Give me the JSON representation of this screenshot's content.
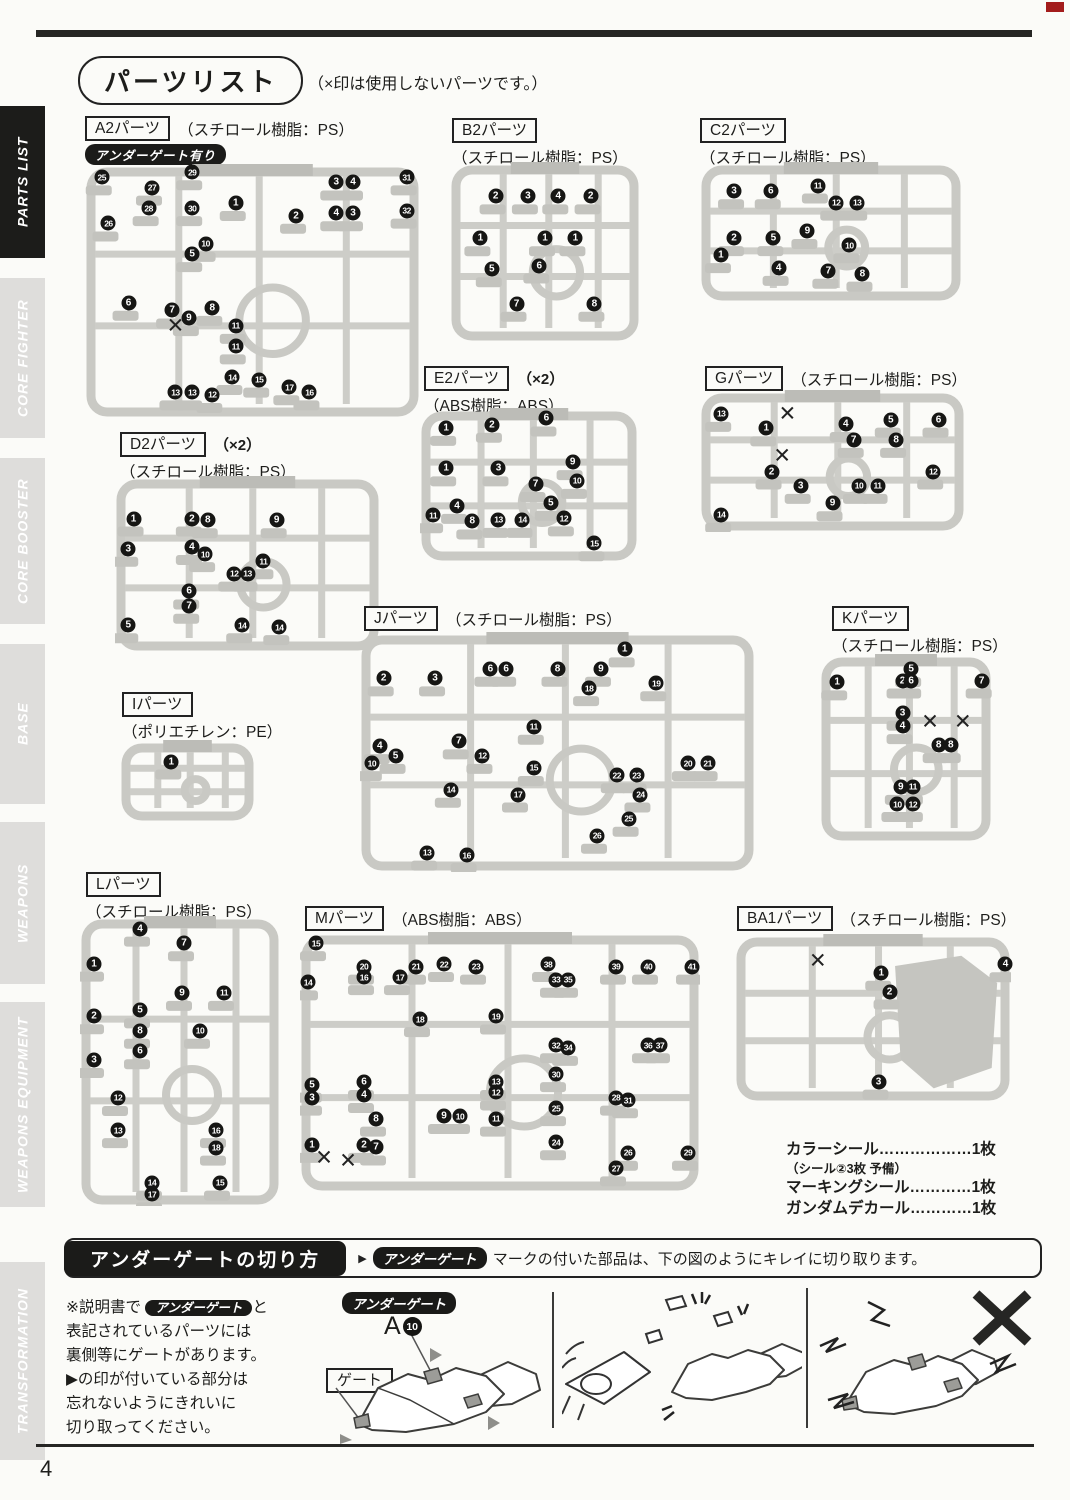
{
  "page": {
    "number": "4"
  },
  "header": {
    "title": "パーツリスト",
    "note": "（×印は使用しないパーツです。）"
  },
  "sidebar": [
    {
      "label": "PARTS LIST",
      "active": true,
      "top": 106,
      "height": 152
    },
    {
      "label": "CORE FIGHTER",
      "top": 278,
      "height": 160
    },
    {
      "label": "CORE BOOSTER",
      "top": 458,
      "height": 166
    },
    {
      "label": "BASE",
      "top": 644,
      "height": 160
    },
    {
      "label": "WEAPONS",
      "top": 822,
      "height": 162
    },
    {
      "label": "WEAPONS EQUIPMENT",
      "top": 1002,
      "height": 205
    },
    {
      "label": "TRANSFORMATION",
      "top": 1262,
      "height": 198
    }
  ],
  "runners": [
    {
      "id": "a2",
      "label": "A2パーツ",
      "mult": "",
      "material": "（スチロール樹脂：PS）",
      "inline": true,
      "badge": "アンダーゲート有り",
      "head": [
        85,
        116
      ],
      "diag": [
        85,
        162,
        335,
        256
      ],
      "nums": [
        [
          25,
          5,
          6
        ],
        [
          27,
          20,
          10
        ],
        [
          29,
          32,
          4
        ],
        [
          28,
          19,
          18
        ],
        [
          26,
          7,
          24
        ],
        [
          30,
          32,
          18
        ],
        [
          1,
          45,
          16
        ],
        [
          2,
          63,
          21
        ],
        [
          3,
          75,
          8
        ],
        [
          4,
          80,
          8
        ],
        [
          4,
          75,
          20
        ],
        [
          3,
          80,
          20
        ],
        [
          31,
          96,
          6
        ],
        [
          32,
          96,
          19
        ],
        [
          5,
          32,
          36
        ],
        [
          10,
          36,
          32
        ],
        [
          6,
          13,
          55
        ],
        [
          7,
          26,
          58
        ],
        [
          9,
          31,
          61
        ],
        [
          8,
          38,
          57
        ],
        [
          11,
          45,
          64
        ],
        [
          11,
          45,
          72
        ],
        [
          13,
          27,
          90
        ],
        [
          13,
          32,
          90
        ],
        [
          12,
          38,
          91
        ],
        [
          14,
          44,
          84
        ],
        [
          15,
          52,
          85
        ],
        [
          17,
          61,
          88
        ],
        [
          16,
          67,
          90
        ]
      ],
      "xmarks": [
        [
          27,
          64
        ]
      ]
    },
    {
      "id": "b2",
      "label": "B2パーツ",
      "mult": "",
      "material": "（スチロール樹脂：PS）",
      "inline": false,
      "badge": "",
      "head": [
        452,
        118
      ],
      "diag": [
        450,
        160,
        190,
        182
      ],
      "nums": [
        [
          2,
          24,
          20
        ],
        [
          3,
          41,
          20
        ],
        [
          4,
          57,
          20
        ],
        [
          2,
          74,
          20
        ],
        [
          1,
          16,
          43
        ],
        [
          1,
          50,
          43
        ],
        [
          1,
          66,
          43
        ],
        [
          5,
          22,
          60
        ],
        [
          6,
          47,
          58
        ],
        [
          7,
          35,
          79
        ],
        [
          8,
          76,
          79
        ]
      ],
      "xmarks": []
    },
    {
      "id": "c2",
      "label": "C2パーツ",
      "mult": "",
      "material": "（スチロール樹脂：PS）",
      "inline": false,
      "badge": "",
      "head": [
        700,
        118
      ],
      "diag": [
        700,
        160,
        262,
        142
      ],
      "nums": [
        [
          3,
          13,
          22
        ],
        [
          6,
          27,
          22
        ],
        [
          11,
          45,
          18
        ],
        [
          12,
          52,
          30
        ],
        [
          13,
          60,
          30
        ],
        [
          2,
          13,
          55
        ],
        [
          5,
          28,
          55
        ],
        [
          9,
          41,
          50
        ],
        [
          10,
          57,
          60
        ],
        [
          1,
          8,
          67
        ],
        [
          4,
          30,
          76
        ],
        [
          7,
          49,
          78
        ],
        [
          8,
          62,
          80
        ]
      ],
      "xmarks": []
    },
    {
      "id": "e2",
      "label": "E2パーツ",
      "mult": "（×2）",
      "material": "（ABS樹脂：ABS）",
      "inline": false,
      "badge": "",
      "head": [
        424,
        366
      ],
      "diag": [
        420,
        406,
        218,
        156
      ],
      "nums": [
        [
          1,
          12,
          14
        ],
        [
          2,
          33,
          12
        ],
        [
          6,
          58,
          8
        ],
        [
          1,
          12,
          40
        ],
        [
          3,
          36,
          40
        ],
        [
          9,
          70,
          36
        ],
        [
          7,
          53,
          50
        ],
        [
          10,
          72,
          48
        ],
        [
          11,
          6,
          70
        ],
        [
          4,
          17,
          64
        ],
        [
          8,
          24,
          74
        ],
        [
          13,
          36,
          73
        ],
        [
          14,
          47,
          73
        ],
        [
          5,
          60,
          62
        ],
        [
          12,
          66,
          72
        ],
        [
          15,
          80,
          88
        ]
      ],
      "xmarks": []
    },
    {
      "id": "g",
      "label": "Gパーツ",
      "mult": "",
      "material": "（スチロール樹脂：PS）",
      "inline": true,
      "badge": "",
      "head": [
        705,
        366
      ],
      "diag": [
        700,
        388,
        265,
        144
      ],
      "nums": [
        [
          13,
          8,
          18
        ],
        [
          1,
          25,
          28
        ],
        [
          4,
          55,
          25
        ],
        [
          5,
          72,
          22
        ],
        [
          6,
          90,
          22
        ],
        [
          7,
          58,
          36
        ],
        [
          8,
          74,
          36
        ],
        [
          2,
          27,
          58
        ],
        [
          3,
          38,
          68
        ],
        [
          10,
          60,
          68
        ],
        [
          11,
          67,
          68
        ],
        [
          12,
          88,
          58
        ],
        [
          9,
          50,
          80
        ],
        [
          14,
          8,
          88
        ]
      ],
      "xmarks": [
        [
          33,
          18
        ],
        [
          31,
          47
        ]
      ]
    },
    {
      "id": "d2",
      "label": "D2パーツ",
      "mult": "（×2）",
      "material": "（スチロール樹脂：PS）",
      "inline": false,
      "badge": "",
      "head": [
        120,
        432
      ],
      "diag": [
        115,
        474,
        265,
        178
      ],
      "nums": [
        [
          1,
          7,
          25
        ],
        [
          2,
          29,
          25
        ],
        [
          8,
          35,
          26
        ],
        [
          9,
          61,
          26
        ],
        [
          3,
          5,
          42
        ],
        [
          4,
          29,
          41
        ],
        [
          10,
          34,
          45
        ],
        [
          11,
          56,
          49
        ],
        [
          12,
          45,
          56
        ],
        [
          13,
          50,
          56
        ],
        [
          6,
          28,
          66
        ],
        [
          7,
          28,
          74
        ],
        [
          5,
          5,
          85
        ],
        [
          14,
          48,
          85
        ],
        [
          14,
          62,
          86
        ]
      ],
      "xmarks": []
    },
    {
      "id": "i",
      "label": "Iパーツ",
      "mult": "",
      "material": "（ポリエチレン：PE）",
      "inline": false,
      "badge": "",
      "head": [
        122,
        692
      ],
      "diag": [
        120,
        738,
        135,
        84
      ],
      "nums": [
        [
          1,
          38,
          28
        ]
      ],
      "xmarks": []
    },
    {
      "id": "j",
      "label": "Jパーツ",
      "mult": "",
      "material": "（スチロール樹脂：PS）",
      "inline": true,
      "badge": "",
      "head": [
        364,
        606
      ],
      "diag": [
        360,
        630,
        395,
        242
      ],
      "nums": [
        [
          2,
          6,
          20
        ],
        [
          3,
          19,
          20
        ],
        [
          6,
          33,
          16
        ],
        [
          6,
          37,
          16
        ],
        [
          8,
          50,
          16
        ],
        [
          9,
          61,
          16
        ],
        [
          1,
          67,
          8
        ],
        [
          18,
          58,
          24
        ],
        [
          19,
          75,
          22
        ],
        [
          20,
          83,
          55
        ],
        [
          21,
          88,
          55
        ],
        [
          4,
          5,
          48
        ],
        [
          7,
          25,
          46
        ],
        [
          10,
          3,
          55
        ],
        [
          12,
          31,
          52
        ],
        [
          11,
          44,
          40
        ],
        [
          5,
          9,
          52
        ],
        [
          15,
          44,
          57
        ],
        [
          17,
          40,
          68
        ],
        [
          14,
          23,
          66
        ],
        [
          13,
          17,
          92
        ],
        [
          16,
          27,
          93
        ],
        [
          22,
          65,
          60
        ],
        [
          23,
          70,
          60
        ],
        [
          24,
          71,
          68
        ],
        [
          25,
          68,
          78
        ],
        [
          26,
          60,
          85
        ]
      ],
      "xmarks": []
    },
    {
      "id": "k",
      "label": "Kパーツ",
      "mult": "",
      "material": "（スチロール樹脂：PS）",
      "inline": false,
      "badge": "",
      "head": [
        832,
        606
      ],
      "diag": [
        820,
        652,
        172,
        190
      ],
      "nums": [
        [
          1,
          10,
          16
        ],
        [
          5,
          53,
          9
        ],
        [
          2,
          48,
          15
        ],
        [
          6,
          53,
          15
        ],
        [
          7,
          94,
          15
        ],
        [
          3,
          48,
          32
        ],
        [
          4,
          48,
          39
        ],
        [
          8,
          69,
          49
        ],
        [
          8,
          76,
          49
        ],
        [
          9,
          47,
          71
        ],
        [
          11,
          54,
          71
        ],
        [
          10,
          45,
          80
        ],
        [
          12,
          54,
          80
        ]
      ],
      "xmarks": [
        [
          64,
          37
        ],
        [
          83,
          37
        ]
      ]
    },
    {
      "id": "l",
      "label": "Lパーツ",
      "mult": "",
      "material": "（スチロール樹脂：PS）",
      "inline": false,
      "badge": "",
      "head": [
        86,
        872
      ],
      "diag": [
        80,
        914,
        200,
        292
      ],
      "nums": [
        [
          4,
          30,
          5
        ],
        [
          7,
          52,
          10
        ],
        [
          1,
          7,
          17
        ],
        [
          9,
          51,
          27
        ],
        [
          11,
          72,
          27
        ],
        [
          5,
          30,
          33
        ],
        [
          8,
          30,
          40
        ],
        [
          2,
          7,
          35
        ],
        [
          10,
          60,
          40
        ],
        [
          6,
          30,
          47
        ],
        [
          3,
          7,
          50
        ],
        [
          12,
          19,
          63
        ],
        [
          13,
          19,
          74
        ],
        [
          16,
          68,
          74
        ],
        [
          18,
          68,
          80
        ],
        [
          14,
          36,
          92
        ],
        [
          17,
          36,
          96
        ],
        [
          15,
          70,
          92
        ]
      ],
      "xmarks": []
    },
    {
      "id": "m",
      "label": "Mパーツ",
      "mult": "",
      "material": "（ABS樹脂：ABS）",
      "inline": true,
      "badge": "",
      "head": [
        305,
        906
      ],
      "diag": [
        300,
        930,
        400,
        262
      ],
      "nums": [
        [
          15,
          4,
          5
        ],
        [
          20,
          16,
          14
        ],
        [
          21,
          29,
          14
        ],
        [
          22,
          36,
          13
        ],
        [
          23,
          44,
          14
        ],
        [
          38,
          62,
          13
        ],
        [
          39,
          79,
          14
        ],
        [
          40,
          87,
          14
        ],
        [
          41,
          98,
          14
        ],
        [
          14,
          2,
          20
        ],
        [
          16,
          16,
          18
        ],
        [
          17,
          25,
          18
        ],
        [
          33,
          64,
          19
        ],
        [
          35,
          67,
          19
        ],
        [
          18,
          30,
          34
        ],
        [
          19,
          49,
          33
        ],
        [
          32,
          64,
          44
        ],
        [
          34,
          67,
          45
        ],
        [
          36,
          87,
          44
        ],
        [
          37,
          90,
          44
        ],
        [
          5,
          3,
          59
        ],
        [
          6,
          16,
          58
        ],
        [
          3,
          3,
          64
        ],
        [
          4,
          16,
          63
        ],
        [
          13,
          49,
          58
        ],
        [
          12,
          49,
          62
        ],
        [
          30,
          64,
          55
        ],
        [
          28,
          79,
          64
        ],
        [
          31,
          82,
          65
        ],
        [
          8,
          19,
          72
        ],
        [
          9,
          36,
          71
        ],
        [
          10,
          40,
          71
        ],
        [
          11,
          49,
          72
        ],
        [
          25,
          64,
          68
        ],
        [
          1,
          3,
          82
        ],
        [
          2,
          16,
          82
        ],
        [
          7,
          19,
          83
        ],
        [
          24,
          64,
          81
        ],
        [
          26,
          82,
          85
        ],
        [
          27,
          79,
          91
        ],
        [
          29,
          97,
          85
        ]
      ],
      "xmarks": [
        [
          6,
          87
        ],
        [
          12,
          88
        ]
      ]
    },
    {
      "id": "ba1",
      "label": "BA1パーツ",
      "mult": "",
      "material": "（スチロール樹脂：PS）",
      "inline": true,
      "badge": "",
      "bigpart": true,
      "head": [
        737,
        906
      ],
      "diag": [
        735,
        932,
        276,
        170
      ],
      "nums": [
        [
          1,
          53,
          24
        ],
        [
          2,
          56,
          35
        ],
        [
          3,
          52,
          88
        ],
        [
          4,
          98,
          19
        ]
      ],
      "xmarks": [
        [
          30,
          17
        ]
      ]
    }
  ],
  "accessories": {
    "l1": "カラーシール………………1枚",
    "l1b": "（シール②3枚 予備）",
    "l2": "マーキングシール…………1枚",
    "l3": "ガンダムデカール…………1枚"
  },
  "undergate": {
    "title": "アンダーゲートの切り方",
    "arrow": "▶",
    "badge": "アンダーゲート",
    "instruction": "マークの付いた部品は、下の図のようにキレイに切り取ります。",
    "note_pre": "※説明書で",
    "note_badge": "アンダーゲート",
    "note_rest": "と\n表記されているパーツには\n裏側等にゲートがあります。\n▶の印が付いている部分は\n忘れないようにきれいに\n切り取ってください。",
    "part_code": "A",
    "part_num": "10",
    "gate_label": "ゲート"
  }
}
